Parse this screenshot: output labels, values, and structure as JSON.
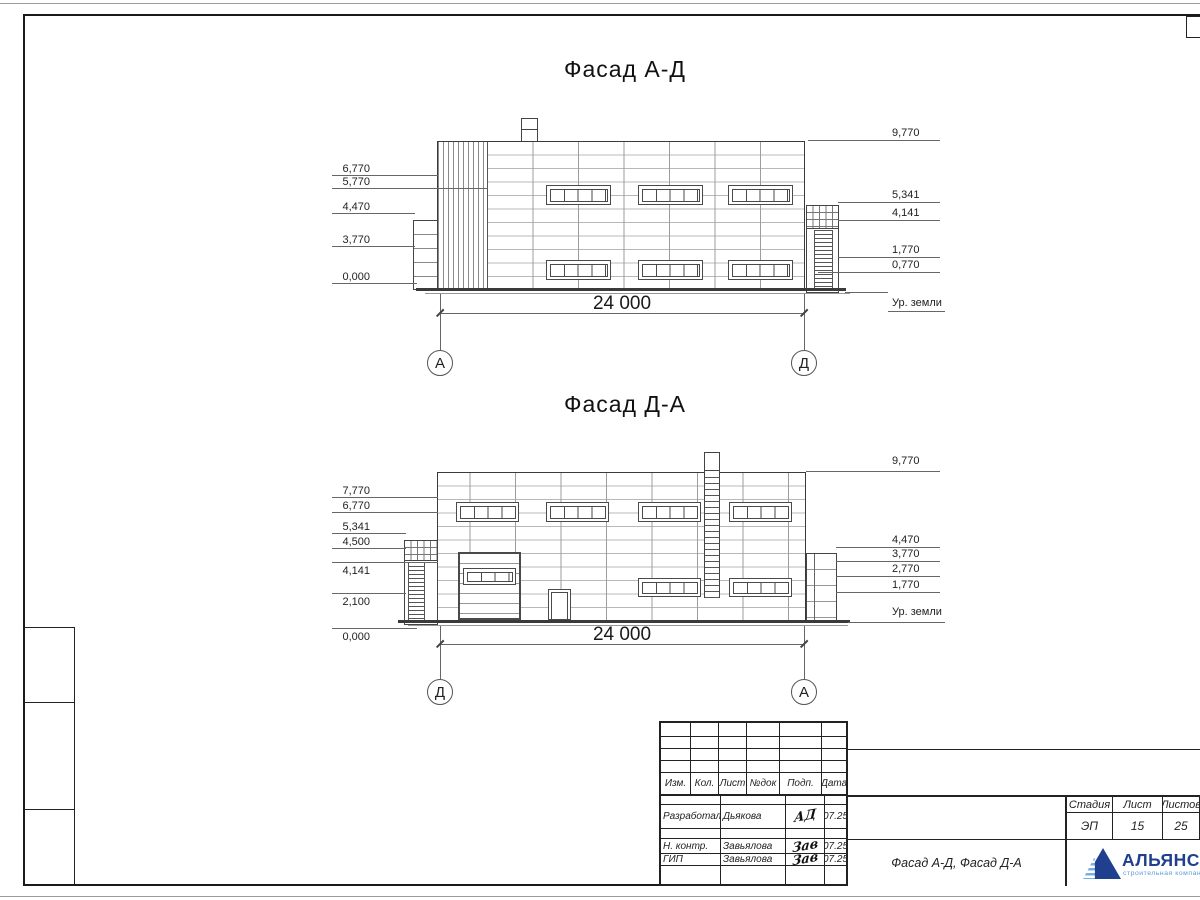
{
  "sheet": {
    "f1": {
      "title": "Фасад А-Д",
      "dim": "24 000",
      "axis_left": "А",
      "axis_right": "Д",
      "left": [
        "6,770",
        "5,770",
        "4,470",
        "3,770",
        "0,000"
      ],
      "right": [
        "9,770",
        "5,341",
        "4,141",
        "1,770",
        "0,770"
      ],
      "ground": "Ур. земли"
    },
    "f2": {
      "title": "Фасад Д-А",
      "dim": "24 000",
      "axis_left": "Д",
      "axis_right": "А",
      "left": [
        "7,770",
        "6,770",
        "5,341",
        "4,500",
        "4,141",
        "2,100",
        "0,000"
      ],
      "right": [
        "9,770",
        "4,470",
        "3,770",
        "2,770",
        "1,770"
      ],
      "ground": "Ур. земли"
    }
  },
  "titleblock": {
    "header": [
      "Изм.",
      "Кол.",
      "Лист",
      "№док",
      "Подп.",
      "Дата"
    ],
    "rows": [
      {
        "role": "Разработал",
        "name": "Дьякова",
        "sig": "АД",
        "date": "07.25"
      },
      {
        "role": "Н. контр.",
        "name": "Завьялова",
        "sig": "Зав",
        "date": "07.25"
      },
      {
        "role": "ГИП",
        "name": "Завьялова",
        "sig": "Зав",
        "date": "07.25"
      }
    ],
    "doc_title": "Фасад А-Д, Фасад Д-А",
    "stage": {
      "headers": [
        "Стадия",
        "Лист",
        "Листов"
      ],
      "values": [
        "ЭП",
        "15",
        "25"
      ]
    },
    "logo": {
      "name": "АЛЬЯНС",
      "subtitle": "строительная компания",
      "navy": "#20408f",
      "blue": "#5b9bd5"
    }
  }
}
